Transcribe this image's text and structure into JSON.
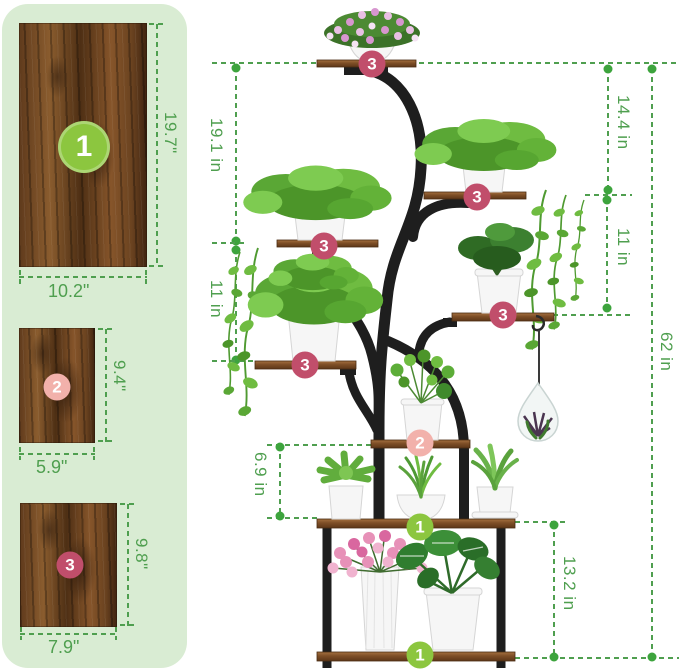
{
  "colors": {
    "panel_bg": "#d9ecd3",
    "measure_green": "#4f9f4f",
    "dot_green": "#3da43d",
    "badge_lime": "#8cc63f",
    "badge_soft_pink": "#f2b1ab",
    "badge_raspberry": "#c14e6b",
    "wood_brown": "#7d4e26",
    "frame_black": "#1e1e1e",
    "pot_white": "#f6f6f6"
  },
  "sidebar": {
    "boards": [
      {
        "num": "1",
        "height": "19.7\"",
        "width": "10.2\""
      },
      {
        "num": "2",
        "height": "9.4\"",
        "width": "5.9\""
      },
      {
        "num": "3",
        "height": "9.8\"",
        "width": "7.9\""
      }
    ]
  },
  "diagram": {
    "badges": {
      "top": "3",
      "right_upper": "3",
      "left_upper": "3",
      "left_lower": "3",
      "right_lower": "3",
      "tier2": "2",
      "tier_mid": "1",
      "tier_bottom": "1"
    },
    "measurements": {
      "left_upper": "19.1 in",
      "left_mid": "11 in",
      "left_lower": "6.9 in",
      "right_upper": "14.4 in",
      "right_mid": "11 in",
      "overall_height": "62 in",
      "bottom_right": "13.2 in"
    }
  }
}
